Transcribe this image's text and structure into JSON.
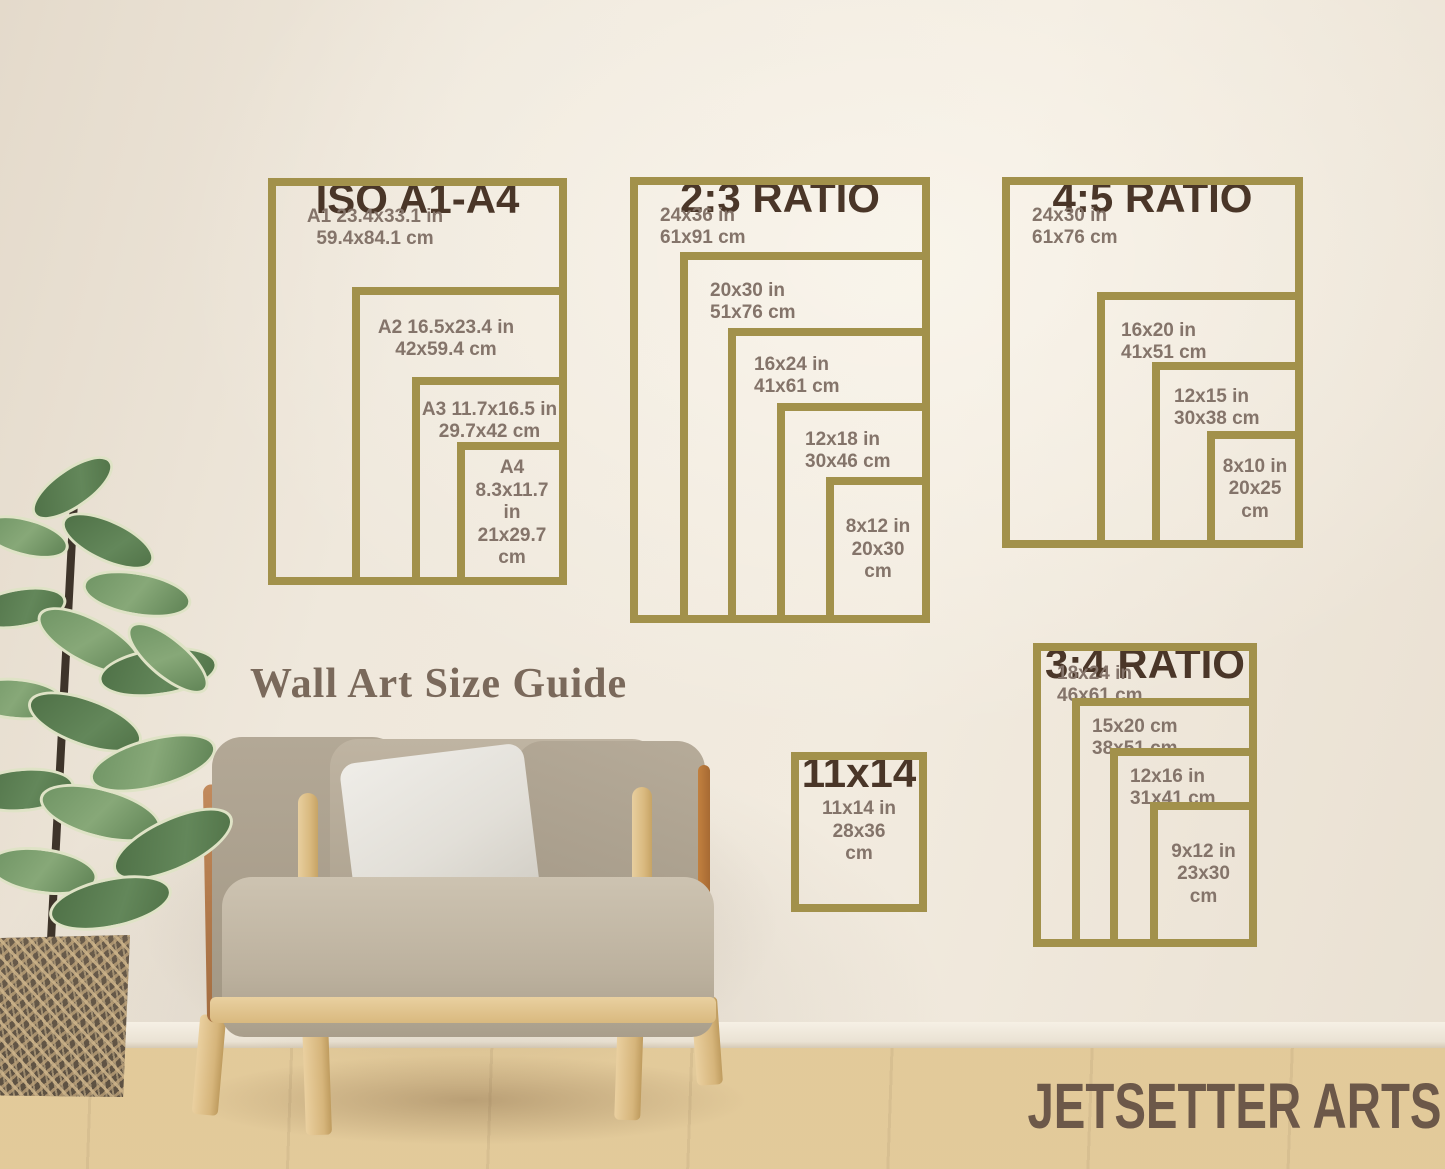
{
  "branding": {
    "caption": "Wall Art Size Guide",
    "watermark": "JETSETTER ARTS"
  },
  "colors": {
    "frame_gold": "#a2914b",
    "title_brown": "#4a3628",
    "label_brown": "#84746a",
    "wall_cream": "#efe8dc",
    "caption_brown": "#7a695b",
    "watermark_brown": "#6c5849"
  },
  "groups": [
    {
      "title": "ISO A1-A4",
      "frames": [
        {
          "name": "A1",
          "label": "A1 23.4x33.1 in\n59.4x84.1 cm"
        },
        {
          "name": "A2",
          "label": "A2 16.5x23.4 in\n42x59.4 cm"
        },
        {
          "name": "A3",
          "label": "A3 11.7x16.5 in\n29.7x42 cm"
        },
        {
          "name": "A4",
          "label": "A4\n8.3x11.7 in\n21x29.7\ncm"
        }
      ]
    },
    {
      "title": "2:3 RATIO",
      "frames": [
        {
          "name": "24x36",
          "label": "24x36 in\n61x91 cm"
        },
        {
          "name": "20x30",
          "label": "20x30 in\n51x76 cm"
        },
        {
          "name": "16x24",
          "label": "16x24 in\n41x61 cm"
        },
        {
          "name": "12x18",
          "label": "12x18 in\n30x46 cm"
        },
        {
          "name": "8x12",
          "label": "8x12 in\n20x30\ncm"
        }
      ]
    },
    {
      "title": "4:5 RATIO",
      "frames": [
        {
          "name": "24x30",
          "label": "24x30 in\n61x76 cm"
        },
        {
          "name": "16x20",
          "label": "16x20 in\n41x51 cm"
        },
        {
          "name": "12x15",
          "label": "12x15 in\n30x38 cm"
        },
        {
          "name": "8x10",
          "label": "8x10 in\n20x25\ncm"
        }
      ]
    },
    {
      "title": "3:4 RATIO",
      "frames": [
        {
          "name": "18x24",
          "label": "18x24 in\n46x61 cm"
        },
        {
          "name": "15x20",
          "label": "15x20 cm\n38x51 cm"
        },
        {
          "name": "12x16",
          "label": "12x16 in\n31x41 cm"
        },
        {
          "name": "9x12",
          "label": "9x12 in\n23x30\ncm"
        }
      ]
    },
    {
      "title": "11x14",
      "frames": [
        {
          "name": "11x14",
          "label": "11x14 in\n28x36\ncm"
        }
      ]
    }
  ]
}
